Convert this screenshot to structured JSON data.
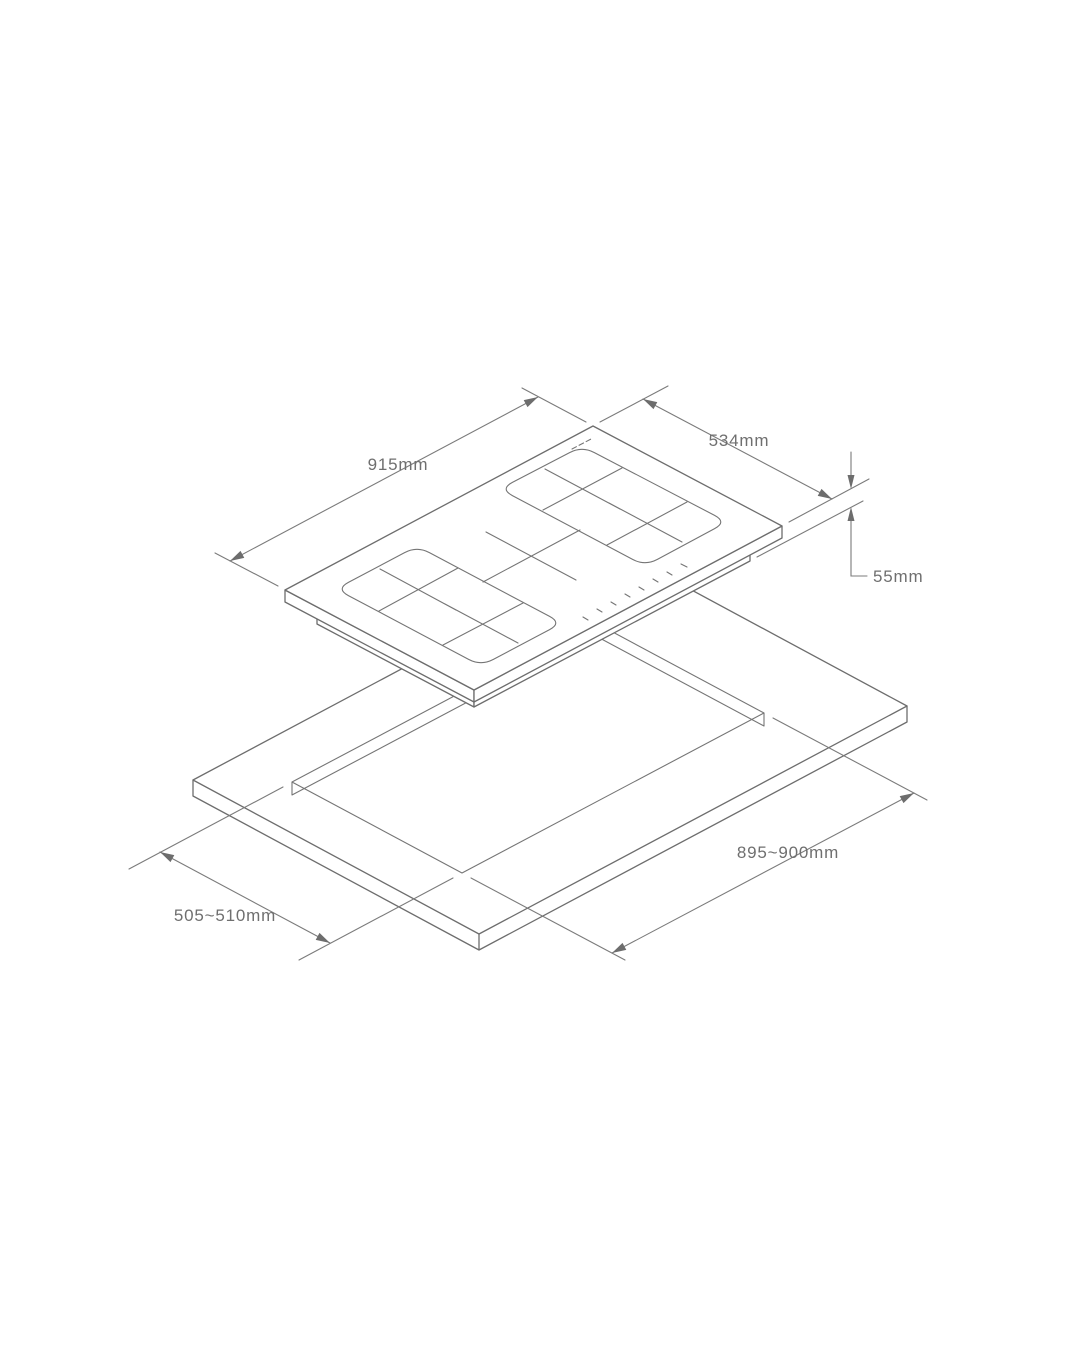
{
  "figure": {
    "type": "isometric-installation-diagram",
    "subject": "induction hob above worktop cutout",
    "background_color": "#ffffff",
    "line_color": "#6d6d6d",
    "text_color": "#6f6f6f"
  },
  "dimensions": {
    "hob_width_label": "915mm",
    "hob_depth_label": "534mm",
    "hob_height_label": "55mm",
    "cutout_length_label": "895~900mm",
    "cutout_width_label": "505~510mm"
  }
}
